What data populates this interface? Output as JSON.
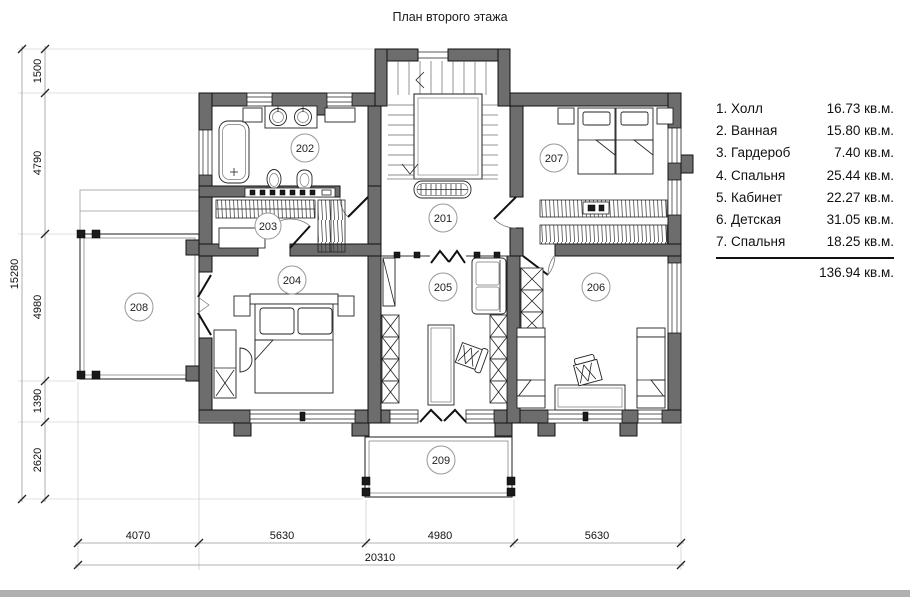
{
  "title": "План второго этажа",
  "legend": {
    "items": [
      {
        "label": "1. Холл",
        "area": "16.73 кв.м."
      },
      {
        "label": "2. Ванная",
        "area": "15.80 кв.м."
      },
      {
        "label": "3. Гардероб",
        "area": "7.40 кв.м."
      },
      {
        "label": "4. Спальня",
        "area": "25.44 кв.м."
      },
      {
        "label": "5. Кабинет",
        "area": "22.27 кв.м."
      },
      {
        "label": "6. Детская",
        "area": "31.05 кв.м."
      },
      {
        "label": "7. Спальня",
        "area": "18.25 кв.м."
      }
    ],
    "total": "136.94 кв.м."
  },
  "room_numbers": [
    "201",
    "202",
    "203",
    "204",
    "205",
    "206",
    "207",
    "208",
    "209"
  ],
  "dimensions": {
    "left": {
      "total": "15280",
      "segments": [
        "1500",
        "4790",
        "4980",
        "1390",
        "2620"
      ]
    },
    "bottom": {
      "total": "20310",
      "segments": [
        "4070",
        "5630",
        "4980",
        "5630"
      ]
    }
  },
  "colors": {
    "wall": "#6d6d6d",
    "footer_bar": "#b0b0b0"
  }
}
